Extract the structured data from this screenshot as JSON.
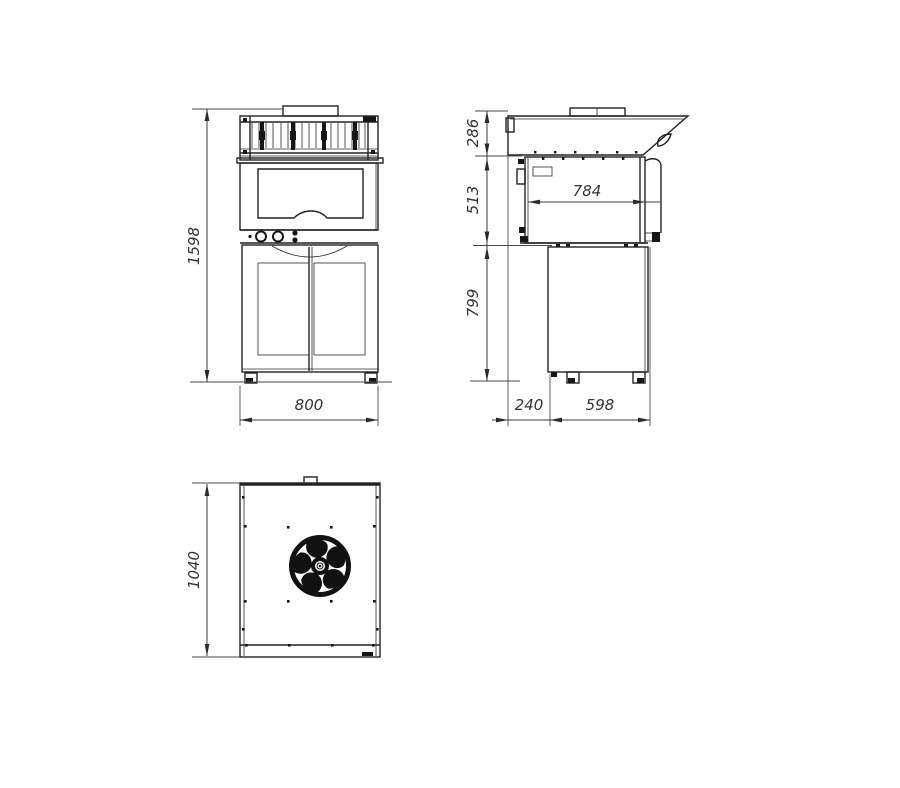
{
  "drawing": {
    "dimensions": {
      "overall_height": "1598",
      "overall_width": "800",
      "hood_height": "286",
      "oven_body_height": "513",
      "base_cabinet_height": "799",
      "oven_body_depth": "784",
      "rear_offset_depth": "240",
      "base_cabinet_depth": "598",
      "top_view_depth": "1040"
    },
    "icons": {
      "fan": "fan-icon"
    },
    "colors": {
      "line": "#222222",
      "dimension": "#3d3d3d",
      "background": "#ffffff"
    }
  }
}
